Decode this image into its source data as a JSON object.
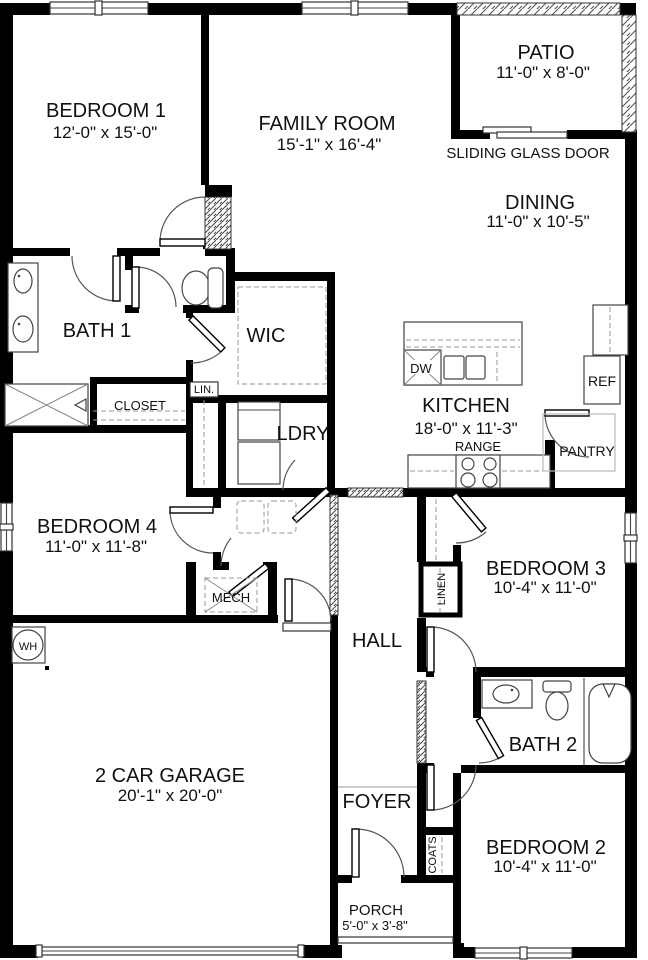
{
  "page": {
    "title": "Floor Plan"
  },
  "colors": {
    "wall": "#000000",
    "line": "#444444",
    "dashed": "#999999",
    "text": "#111111",
    "background": "#ffffff"
  },
  "rooms": {
    "bedroom1": {
      "name": "BEDROOM 1",
      "dims": "12'-0\" x 15'-0\""
    },
    "family_room": {
      "name": "FAMILY ROOM",
      "dims": "15'-1\" x 16'-4\""
    },
    "patio": {
      "name": "PATIO",
      "dims": "11'-0\" x 8'-0\""
    },
    "dining": {
      "name": "DINING",
      "dims": "11'-0\" x 10'-5\""
    },
    "kitchen": {
      "name": "KITCHEN",
      "dims": "18'-0\" x 11'-3\""
    },
    "bedroom4": {
      "name": "BEDROOM 4",
      "dims": "11'-0\" x 11'-8\""
    },
    "bedroom3": {
      "name": "BEDROOM 3",
      "dims": "10'-4\" x 11'-0\""
    },
    "bedroom2": {
      "name": "BEDROOM 2",
      "dims": "10'-4\" x 11'-0\""
    },
    "garage": {
      "name": "2 CAR GARAGE",
      "dims": "20'-1\" x 20'-0\""
    },
    "porch": {
      "name": "PORCH",
      "dims": "5'-0\" x 3'-8\""
    },
    "bath1": {
      "name": "BATH 1"
    },
    "bath2": {
      "name": "BATH 2"
    },
    "wic": {
      "name": "WIC"
    },
    "hall": {
      "name": "HALL"
    },
    "foyer": {
      "name": "FOYER"
    },
    "ldry": {
      "name": "LDRY"
    },
    "closet": {
      "name": "CLOSET"
    },
    "mech": {
      "name": "MECH"
    }
  },
  "fixtures": {
    "sliding_door": "SLIDING GLASS DOOR",
    "pantry": "PANTRY",
    "refrigerator": "REF",
    "dishwasher": "DW",
    "range": "RANGE",
    "linen_small": "LIN.",
    "linen": "LINEN",
    "coats": "COATS",
    "water_heater": "WH"
  }
}
